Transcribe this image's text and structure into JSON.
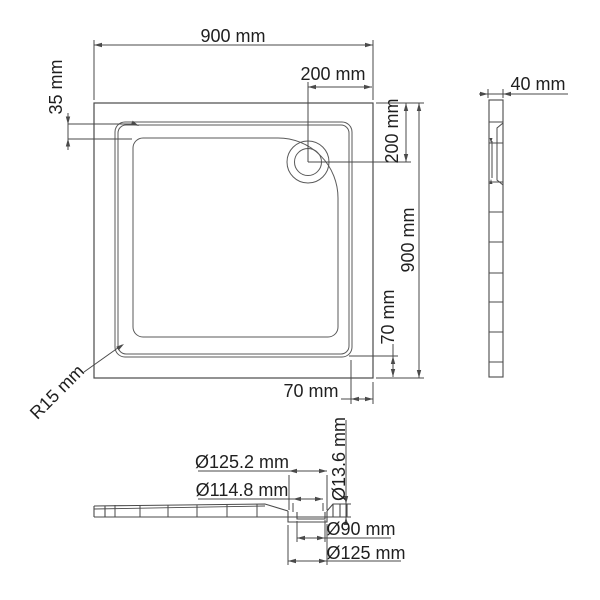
{
  "drawing": {
    "colors": {
      "line": "#4a4a4a",
      "text": "#1f1f1f",
      "background": "#ffffff"
    },
    "labels": {
      "overall_width_top": "900 mm",
      "wall_top_offset": "35 mm",
      "drain_offset_x": "200 mm",
      "drain_offset_y": "200 mm",
      "overall_height_right": "900 mm",
      "floor_offset_right": "70 mm",
      "floor_offset_bottom": "70 mm",
      "corner_radius": "R15 mm",
      "side_width": "40 mm",
      "drain_top_outer_dia": "Ø125.2 mm",
      "drain_top_inner_dia": "Ø114.8 mm",
      "drain_height": "Ø13.6 mm",
      "drain_hole_dia": "Ø90 mm",
      "drain_bottom_dia": "Ø125 mm"
    }
  }
}
